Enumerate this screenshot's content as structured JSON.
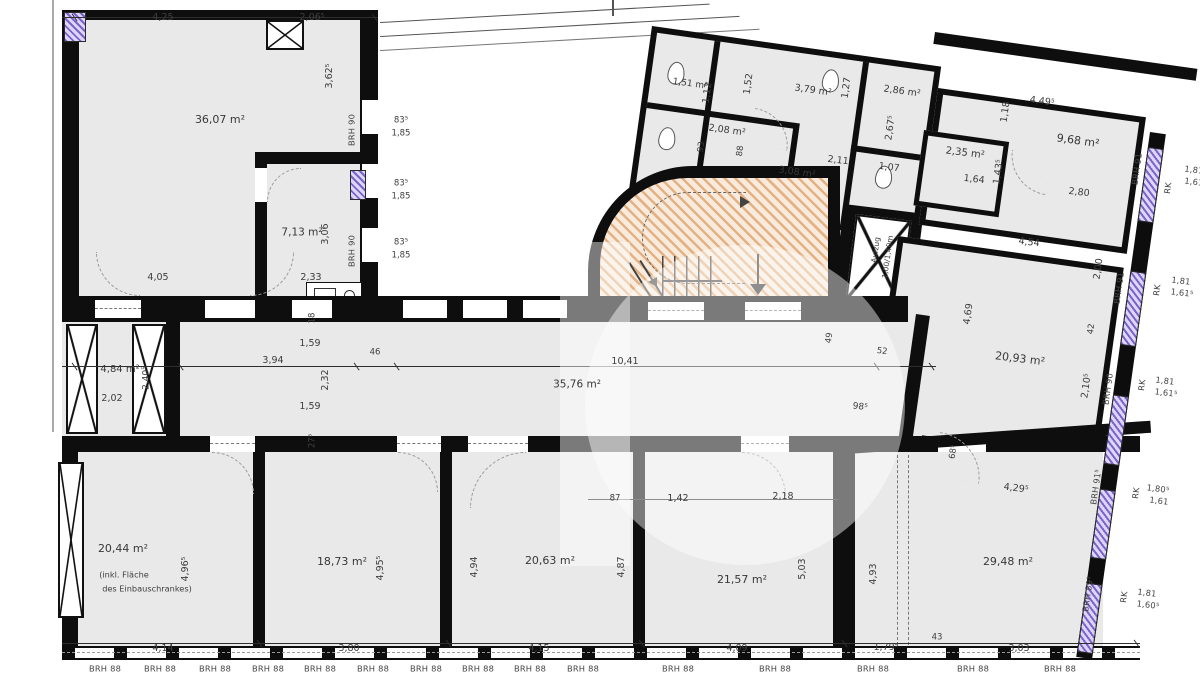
{
  "plan": {
    "type": "architectural-floor-plan",
    "colors": {
      "wall": "#0e0e0e",
      "room_fill": "#e9e9e9",
      "window_accent": "#7a63cc",
      "stair_hatch": "#d17828",
      "label_text": "#3d3d3d"
    }
  },
  "room_labels": [
    {
      "text": "36,07 m²",
      "x": 220,
      "y": 120,
      "rot": 0,
      "fs": 11,
      "name": "room-area-36-07"
    },
    {
      "text": "7,13 m²",
      "x": 302,
      "y": 233,
      "rot": 0,
      "fs": 10.5,
      "name": "room-area-7-13"
    },
    {
      "text": "35,76 m²",
      "x": 577,
      "y": 385,
      "rot": 0,
      "fs": 10.5,
      "name": "room-area-35-76"
    },
    {
      "text": "4,84 m²",
      "x": 120,
      "y": 370,
      "rot": 0,
      "fs": 10,
      "name": "room-area-4-84"
    },
    {
      "text": "20,44 m²",
      "x": 123,
      "y": 549,
      "rot": 0,
      "fs": 11,
      "name": "room-area-20-44"
    },
    {
      "text": "18,73 m²",
      "x": 342,
      "y": 562,
      "rot": 0,
      "fs": 11,
      "name": "room-area-18-73"
    },
    {
      "text": "20,63 m²",
      "x": 550,
      "y": 561,
      "rot": 0,
      "fs": 11,
      "name": "room-area-20-63"
    },
    {
      "text": "21,57 m²",
      "x": 742,
      "y": 580,
      "rot": 0,
      "fs": 11,
      "name": "room-area-21-57"
    },
    {
      "text": "29,48 m²",
      "x": 1008,
      "y": 562,
      "rot": 0,
      "fs": 11,
      "name": "room-area-29-48"
    },
    {
      "text": "20,93 m²",
      "x": 1020,
      "y": 359,
      "rot": 7,
      "fs": 11,
      "name": "room-area-20-93"
    },
    {
      "text": "9,68 m²",
      "x": 1078,
      "y": 141,
      "rot": 8,
      "fs": 11,
      "name": "room-area-9-68"
    },
    {
      "text": "3,79 m²",
      "x": 813,
      "y": 91,
      "rot": 8,
      "fs": 9.5,
      "name": "room-area-3-79"
    },
    {
      "text": "1,51 m²",
      "x": 690,
      "y": 85,
      "rot": 8,
      "fs": 9,
      "name": "room-area-1-51"
    },
    {
      "text": "2,08 m²",
      "x": 727,
      "y": 131,
      "rot": 8,
      "fs": 9.5,
      "name": "room-area-2-08"
    },
    {
      "text": "3,08 m²",
      "x": 797,
      "y": 173,
      "rot": 8,
      "fs": 9.5,
      "name": "room-area-3-08"
    },
    {
      "text": "2,86 m²",
      "x": 902,
      "y": 92,
      "rot": 8,
      "fs": 9.5,
      "name": "room-area-2-86"
    },
    {
      "text": "2,35 m²",
      "x": 965,
      "y": 154,
      "rot": 7,
      "fs": 10,
      "name": "room-area-2-35"
    }
  ],
  "dimension_labels": [
    {
      "text": "4,25",
      "x": 163,
      "y": 18,
      "rot": 0
    },
    {
      "text": "2,06⁵",
      "x": 312,
      "y": 18,
      "rot": 0
    },
    {
      "text": "3,62⁵",
      "x": 330,
      "y": 76,
      "rot": -90
    },
    {
      "text": "3,06",
      "x": 326,
      "y": 234,
      "rot": -90
    },
    {
      "text": "4,05",
      "x": 158,
      "y": 278,
      "rot": 0
    },
    {
      "text": "2,33",
      "x": 311,
      "y": 278,
      "rot": 0
    },
    {
      "text": "83⁵",
      "x": 401,
      "y": 121,
      "rot": 0,
      "fs": 8.5
    },
    {
      "text": "1,85",
      "x": 401,
      "y": 134,
      "rot": 0,
      "fs": 8.5
    },
    {
      "text": "83⁵",
      "x": 401,
      "y": 184,
      "rot": 0,
      "fs": 8.5
    },
    {
      "text": "1,85",
      "x": 401,
      "y": 197,
      "rot": 0,
      "fs": 8.5
    },
    {
      "text": "83⁵",
      "x": 401,
      "y": 243,
      "rot": 0,
      "fs": 8.5
    },
    {
      "text": "1,85",
      "x": 401,
      "y": 256,
      "rot": 0,
      "fs": 8.5
    },
    {
      "text": "1,59",
      "x": 310,
      "y": 344,
      "rot": 0
    },
    {
      "text": "3,94",
      "x": 273,
      "y": 361,
      "rot": 0
    },
    {
      "text": "46",
      "x": 375,
      "y": 353,
      "rot": 0,
      "fs": 8.5
    },
    {
      "text": "2,32",
      "x": 326,
      "y": 380,
      "rot": -90
    },
    {
      "text": "18",
      "x": 313,
      "y": 318,
      "rot": -90,
      "fs": 8.5
    },
    {
      "text": "1,59",
      "x": 310,
      "y": 407,
      "rot": 0
    },
    {
      "text": "27⁵",
      "x": 313,
      "y": 441,
      "rot": -90,
      "fs": 8.5
    },
    {
      "text": "10,41",
      "x": 625,
      "y": 362,
      "rot": 0
    },
    {
      "text": "49",
      "x": 830,
      "y": 338,
      "rot": -82,
      "fs": 8.5
    },
    {
      "text": "52",
      "x": 882,
      "y": 352,
      "rot": 7,
      "fs": 8.5
    },
    {
      "text": "98⁵",
      "x": 860,
      "y": 408,
      "rot": 7,
      "fs": 9
    },
    {
      "text": "2,02",
      "x": 112,
      "y": 399,
      "rot": 0
    },
    {
      "text": "2,40⁵",
      "x": 147,
      "y": 378,
      "rot": -90,
      "fs": 9
    },
    {
      "text": "4,96⁵",
      "x": 186,
      "y": 569,
      "rot": -90
    },
    {
      "text": "4,14",
      "x": 163,
      "y": 649,
      "rot": 0
    },
    {
      "text": "4,95⁵",
      "x": 381,
      "y": 568,
      "rot": -90
    },
    {
      "text": "3,80",
      "x": 349,
      "y": 649,
      "rot": 0
    },
    {
      "text": "4,94",
      "x": 475,
      "y": 567,
      "rot": -90
    },
    {
      "text": "4,87",
      "x": 622,
      "y": 567,
      "rot": -90
    },
    {
      "text": "4,15",
      "x": 539,
      "y": 649,
      "rot": 0
    },
    {
      "text": "87",
      "x": 615,
      "y": 499,
      "rot": 0,
      "fs": 8.5
    },
    {
      "text": "1,42",
      "x": 678,
      "y": 499,
      "rot": 0
    },
    {
      "text": "2,18",
      "x": 783,
      "y": 497,
      "rot": 0
    },
    {
      "text": "5,03",
      "x": 803,
      "y": 569,
      "rot": -90
    },
    {
      "text": "4,09",
      "x": 737,
      "y": 649,
      "rot": 0
    },
    {
      "text": "4,93",
      "x": 874,
      "y": 574,
      "rot": -90
    },
    {
      "text": "1,79⁵",
      "x": 886,
      "y": 648,
      "rot": 0
    },
    {
      "text": "43",
      "x": 937,
      "y": 638,
      "rot": 0,
      "fs": 8.5
    },
    {
      "text": "3,03",
      "x": 1019,
      "y": 649,
      "rot": 0
    },
    {
      "text": "4,29⁵",
      "x": 1016,
      "y": 489,
      "rot": 7
    },
    {
      "text": "68⁵",
      "x": 954,
      "y": 452,
      "rot": -82,
      "fs": 8.5
    },
    {
      "text": "4,54",
      "x": 1029,
      "y": 243,
      "rot": 7
    },
    {
      "text": "4,69",
      "x": 969,
      "y": 314,
      "rot": -82
    },
    {
      "text": "2,00",
      "x": 1099,
      "y": 269,
      "rot": -82
    },
    {
      "text": "42",
      "x": 1092,
      "y": 329,
      "rot": -82,
      "fs": 8.5
    },
    {
      "text": "2,10⁵",
      "x": 1087,
      "y": 386,
      "rot": -82
    },
    {
      "text": "4,49⁵",
      "x": 1042,
      "y": 102,
      "rot": 8
    },
    {
      "text": "1,18",
      "x": 1006,
      "y": 112,
      "rot": -82
    },
    {
      "text": "2,80",
      "x": 1079,
      "y": 193,
      "rot": 7
    },
    {
      "text": "1,64",
      "x": 974,
      "y": 180,
      "rot": 7
    },
    {
      "text": "1,43⁵",
      "x": 999,
      "y": 172,
      "rot": -82
    },
    {
      "text": "2,67⁵",
      "x": 891,
      "y": 128,
      "rot": -82
    },
    {
      "text": "1,07",
      "x": 889,
      "y": 168,
      "rot": 7
    },
    {
      "text": "2,11",
      "x": 838,
      "y": 161,
      "rot": 7
    },
    {
      "text": "1,12",
      "x": 708,
      "y": 93,
      "rot": -82
    },
    {
      "text": "1,52",
      "x": 749,
      "y": 84,
      "rot": -82
    },
    {
      "text": "1,27",
      "x": 847,
      "y": 88,
      "rot": -82
    },
    {
      "text": "93",
      "x": 702,
      "y": 147,
      "rot": -82,
      "fs": 8.5
    },
    {
      "text": "88",
      "x": 741,
      "y": 151,
      "rot": -82,
      "fs": 8.5
    }
  ],
  "window_labels": [
    {
      "text": "BRH 90",
      "x": 352,
      "y": 130,
      "rot": -90
    },
    {
      "text": "BRH 90",
      "x": 352,
      "y": 251,
      "rot": -90
    },
    {
      "text": "BRH 91",
      "x": 1137,
      "y": 169,
      "rot": -82
    },
    {
      "text": "RK",
      "x": 1168,
      "y": 188,
      "rot": -82
    },
    {
      "text": "1,81",
      "x": 1194,
      "y": 170,
      "rot": 7
    },
    {
      "text": "1,61",
      "x": 1194,
      "y": 182,
      "rot": 7
    },
    {
      "text": "BRH 91",
      "x": 1119,
      "y": 288,
      "rot": -82
    },
    {
      "text": "RK",
      "x": 1157,
      "y": 290,
      "rot": -82
    },
    {
      "text": "1,81",
      "x": 1181,
      "y": 281,
      "rot": 7
    },
    {
      "text": "1,61⁵",
      "x": 1182,
      "y": 293,
      "rot": 7
    },
    {
      "text": "BRH 90",
      "x": 1108,
      "y": 389,
      "rot": -82
    },
    {
      "text": "RK",
      "x": 1142,
      "y": 385,
      "rot": -82
    },
    {
      "text": "1,81",
      "x": 1165,
      "y": 381,
      "rot": 7
    },
    {
      "text": "1,61⁵",
      "x": 1166,
      "y": 393,
      "rot": 7
    },
    {
      "text": "BRH 91⁵",
      "x": 1096,
      "y": 487,
      "rot": -82
    },
    {
      "text": "RK",
      "x": 1136,
      "y": 493,
      "rot": -82
    },
    {
      "text": "1,80⁵",
      "x": 1158,
      "y": 489,
      "rot": 7
    },
    {
      "text": "1,61",
      "x": 1159,
      "y": 501,
      "rot": 7
    },
    {
      "text": "BRH 89⁵",
      "x": 1088,
      "y": 594,
      "rot": -82
    },
    {
      "text": "RK",
      "x": 1124,
      "y": 597,
      "rot": -82
    },
    {
      "text": "1,81",
      "x": 1147,
      "y": 593,
      "rot": 7
    },
    {
      "text": "1,60⁵",
      "x": 1148,
      "y": 605,
      "rot": 7
    },
    {
      "text": "BRH 88",
      "x": 105,
      "y": 669,
      "rot": 0
    },
    {
      "text": "BRH 88",
      "x": 160,
      "y": 669,
      "rot": 0
    },
    {
      "text": "BRH 88",
      "x": 215,
      "y": 669,
      "rot": 0
    },
    {
      "text": "BRH 88",
      "x": 268,
      "y": 669,
      "rot": 0
    },
    {
      "text": "BRH 88",
      "x": 320,
      "y": 669,
      "rot": 0
    },
    {
      "text": "BRH 88",
      "x": 373,
      "y": 669,
      "rot": 0
    },
    {
      "text": "BRH 88",
      "x": 426,
      "y": 669,
      "rot": 0
    },
    {
      "text": "BRH 88",
      "x": 478,
      "y": 669,
      "rot": 0
    },
    {
      "text": "BRH 88",
      "x": 530,
      "y": 669,
      "rot": 0
    },
    {
      "text": "BRH 88",
      "x": 583,
      "y": 669,
      "rot": 0
    },
    {
      "text": "BRH 88",
      "x": 678,
      "y": 669,
      "rot": 0
    },
    {
      "text": "BRH 88",
      "x": 775,
      "y": 669,
      "rot": 0
    },
    {
      "text": "BRH 88",
      "x": 873,
      "y": 669,
      "rot": 0
    },
    {
      "text": "BRH 88",
      "x": 973,
      "y": 669,
      "rot": 0
    },
    {
      "text": "BRH 88",
      "x": 1060,
      "y": 669,
      "rot": 0
    }
  ],
  "annotations": [
    {
      "text": "(inkl. Fläche",
      "x": 124,
      "y": 575,
      "rot": 0
    },
    {
      "text": "des Einbauschrankes)",
      "x": 147,
      "y": 589,
      "rot": 0
    },
    {
      "text": "Aufzug",
      "x": 876,
      "y": 250,
      "rot": -82,
      "fs": 7.5
    },
    {
      "text": "1,00/1,40m",
      "x": 888,
      "y": 257,
      "rot": -82,
      "fs": 7.5
    }
  ]
}
